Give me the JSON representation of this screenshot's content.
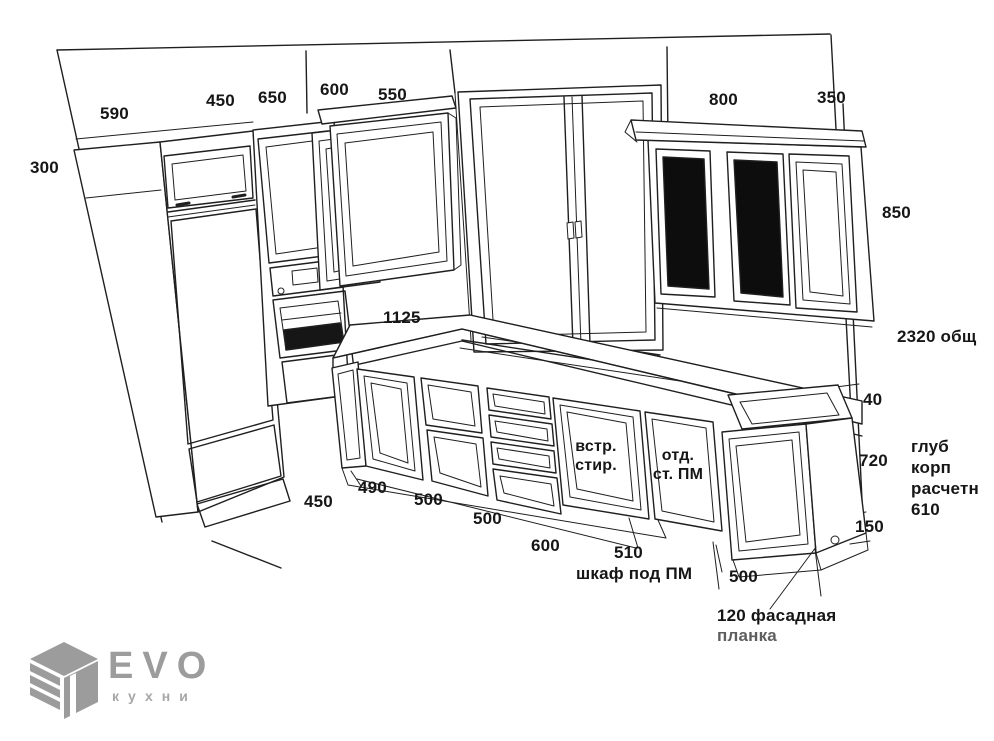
{
  "colors": {
    "ink": "#1c1c1c",
    "dark_glass": "#0d0d0d",
    "logo_gray": "#9c9c9c"
  },
  "labels": {
    "top": {
      "d590": "590",
      "d450": "450",
      "d650": "650",
      "d600": "600",
      "d550": "550",
      "d800": "800",
      "d350": "350"
    },
    "left": {
      "d300": "300"
    },
    "right": {
      "d850": "850",
      "total": "2320 общ",
      "d40": "40",
      "d720": "720",
      "depth": "глуб\nкорп\nрасчетн\n610",
      "d150": "150"
    },
    "mid": {
      "d1125": "1125",
      "washer": "встр.\nстир.",
      "dishwasher": "отд.\nст. ПМ"
    },
    "bottom": {
      "d450": "450",
      "d490": "490",
      "d500a": "500",
      "d500b": "500",
      "d600": "600",
      "d510": "510",
      "caption": "шкаф под ПМ",
      "d500c": "500",
      "facade1": "120 фасадная",
      "facade2": "планка"
    }
  },
  "logo": {
    "brand": "EVO",
    "division": "кухни"
  }
}
